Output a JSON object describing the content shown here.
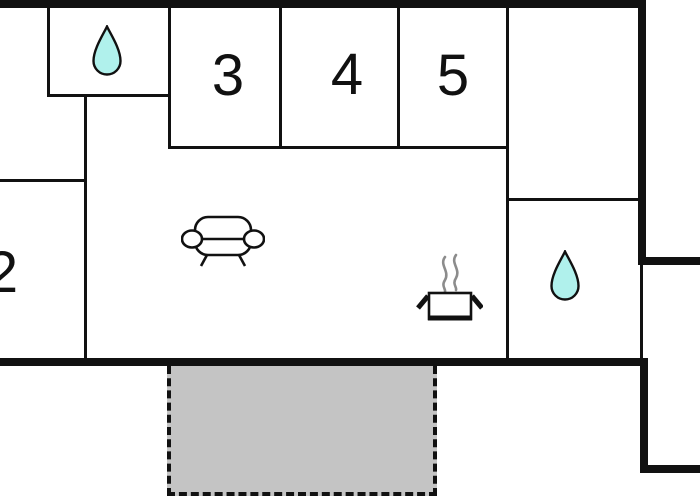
{
  "colors": {
    "background": "#ffffff",
    "wall": "#111111",
    "water_drop": "#b0f1ec",
    "terrace_fill": "#c4c4c4",
    "steam": "#8c8c8c"
  },
  "rooms": {
    "r2": {
      "label": "2"
    },
    "r3": {
      "label": "3"
    },
    "r4": {
      "label": "4"
    },
    "r5": {
      "label": "5"
    }
  },
  "icons": {
    "bathroom_top_left": "water-drop-icon",
    "bathroom_right": "water-drop-icon",
    "living_room": "sofa-icon",
    "kitchen": "cooking-pot-icon"
  },
  "areas": {
    "terrace": "terrace-dashed-area"
  }
}
